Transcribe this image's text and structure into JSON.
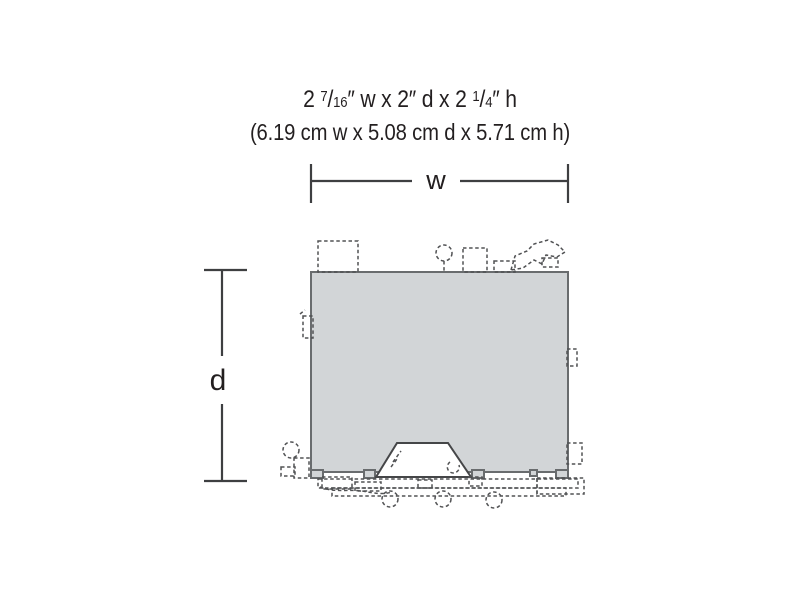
{
  "header": {
    "imperial": {
      "seg1": "2 ",
      "frac1_num": "7",
      "frac1_slash": "/",
      "frac1_den": "16",
      "seg2": "″ w x 2″ d x 2 ",
      "frac2_num": "1",
      "frac2_slash": "/",
      "frac2_den": "4",
      "seg3": "″ h"
    },
    "metric": "(6.19 cm w x 5.08 cm d x 5.71 cm h)"
  },
  "dimension_labels": {
    "width": "w",
    "depth": "d"
  },
  "colors": {
    "text": "#231f20",
    "dimension_lines": "#3e3f41",
    "footprint_fill": "#d2d5d7",
    "footprint_border": "#696c6e",
    "detail_dashed_outline": "#515254",
    "entrance_fill": "#ffffff",
    "background": "#ffffff"
  }
}
